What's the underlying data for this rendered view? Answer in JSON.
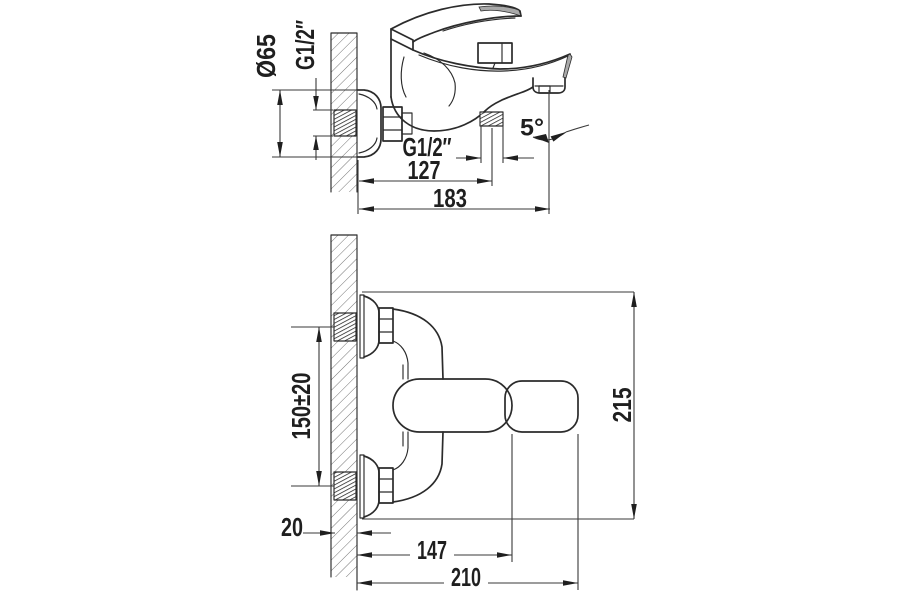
{
  "drawing": {
    "description": "Dimensioned two-view technical drawing of a wall-mounted single-lever bath mixer faucet",
    "colors": {
      "background": "#ffffff",
      "line": "#2b2b2b",
      "dimension_line": "#3a3a3a",
      "text": "#1f1f1f"
    },
    "side_view": {
      "labels": {
        "flange_diameter": "Ø65",
        "wall_thread": "G1/2″",
        "hose_thread": "G1/2″",
        "hose_center_offset": "127",
        "overall_depth": "183",
        "spout_angle": "5°"
      }
    },
    "plan_view": {
      "labels": {
        "connection_centers": "150±20",
        "overall_height": "215",
        "wall_offset": "20",
        "body_length": "147",
        "overall_length": "210"
      }
    }
  }
}
